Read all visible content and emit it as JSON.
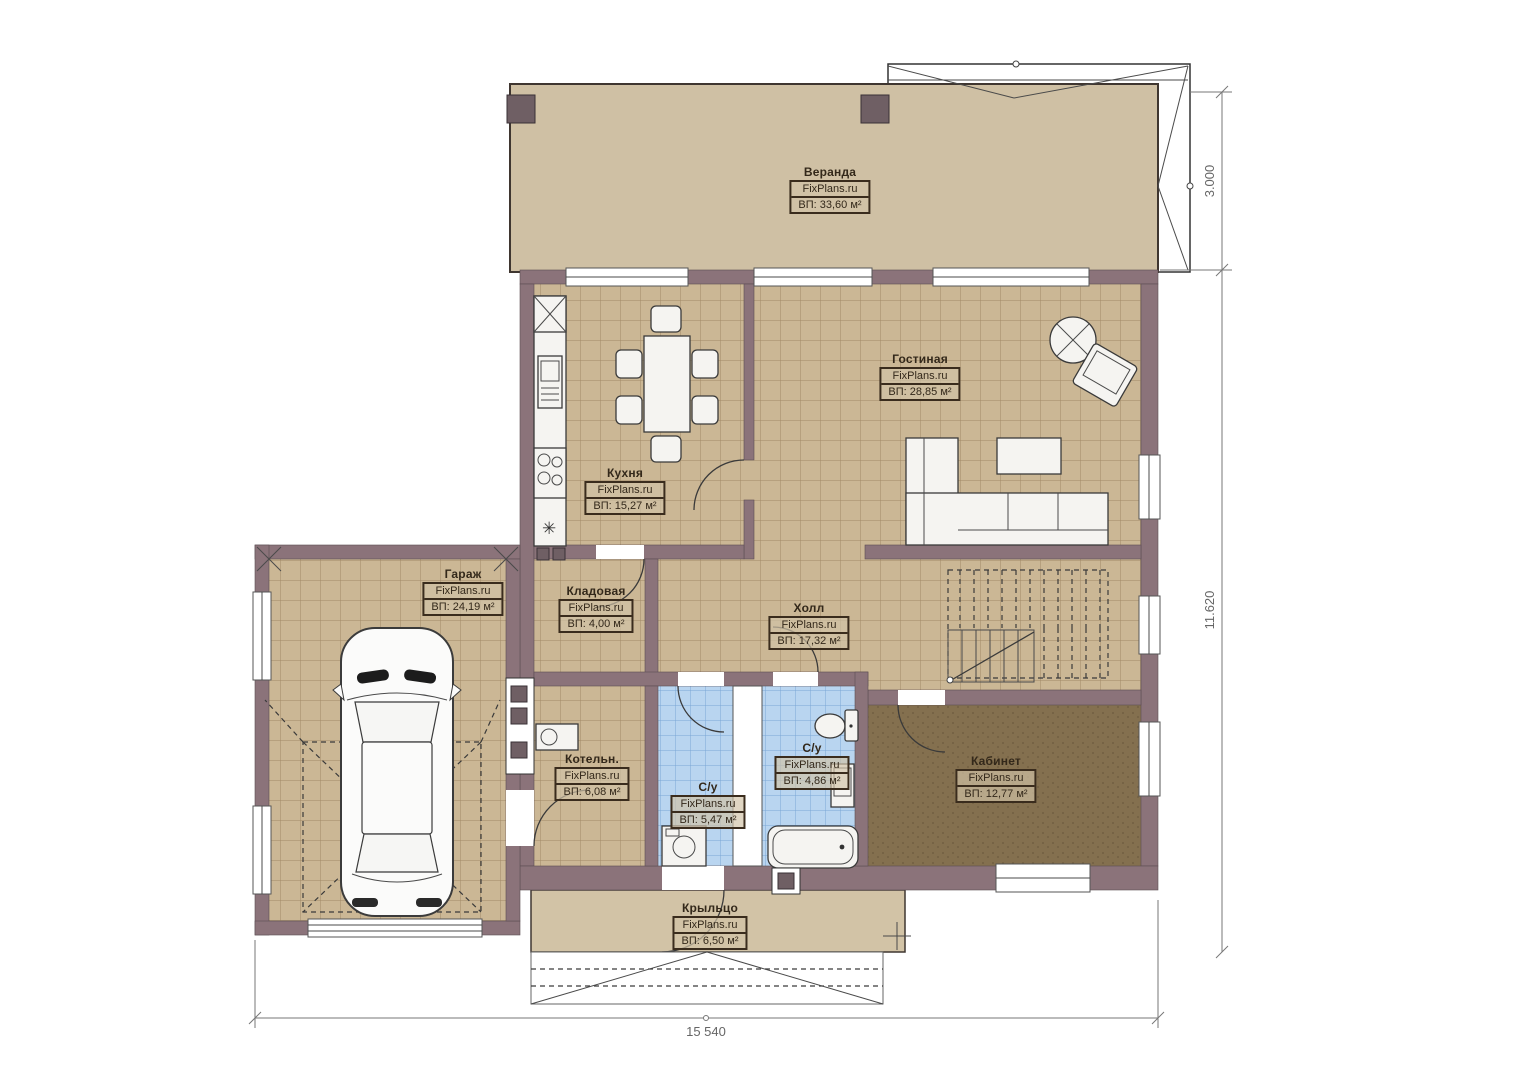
{
  "plan": {
    "watermark": "FixPlans.ru",
    "rooms": [
      {
        "id": "veranda",
        "name": "Веранда",
        "area": "ВП: 33,60 м²"
      },
      {
        "id": "gostinaya",
        "name": "Гостиная",
        "area": "ВП: 28,85 м²"
      },
      {
        "id": "kuhnya",
        "name": "Кухня",
        "area": "ВП: 15,27 м²"
      },
      {
        "id": "garazh",
        "name": "Гараж",
        "area": "ВП: 24,19 м²"
      },
      {
        "id": "kladovaya",
        "name": "Кладовая",
        "area": "ВП: 4,00 м²"
      },
      {
        "id": "holl",
        "name": "Холл",
        "area": "ВП: 17,32 м²"
      },
      {
        "id": "kotelnaya",
        "name": "Котельн.",
        "area": "ВП: 6,08 м²"
      },
      {
        "id": "su-1",
        "name": "С/у",
        "area": "ВП: 5,47 м²"
      },
      {
        "id": "su-2",
        "name": "С/у",
        "area": "ВП: 4,86 м²"
      },
      {
        "id": "kabinet",
        "name": "Кабинет",
        "area": "ВП: 12,77 м²"
      },
      {
        "id": "krylco",
        "name": "Крыльцо",
        "area": "ВП: 6,50 м²"
      }
    ],
    "dimensions": {
      "veranda_depth": "3.000",
      "house_height": "11.620",
      "total_width": "15 540"
    },
    "colors": {
      "wall": "#8b737a",
      "floor_tile": "#cbb795",
      "bathroom_tile": "#b9d5f0",
      "office_floor": "#84704f",
      "veranda": "#cfc0a4"
    }
  }
}
